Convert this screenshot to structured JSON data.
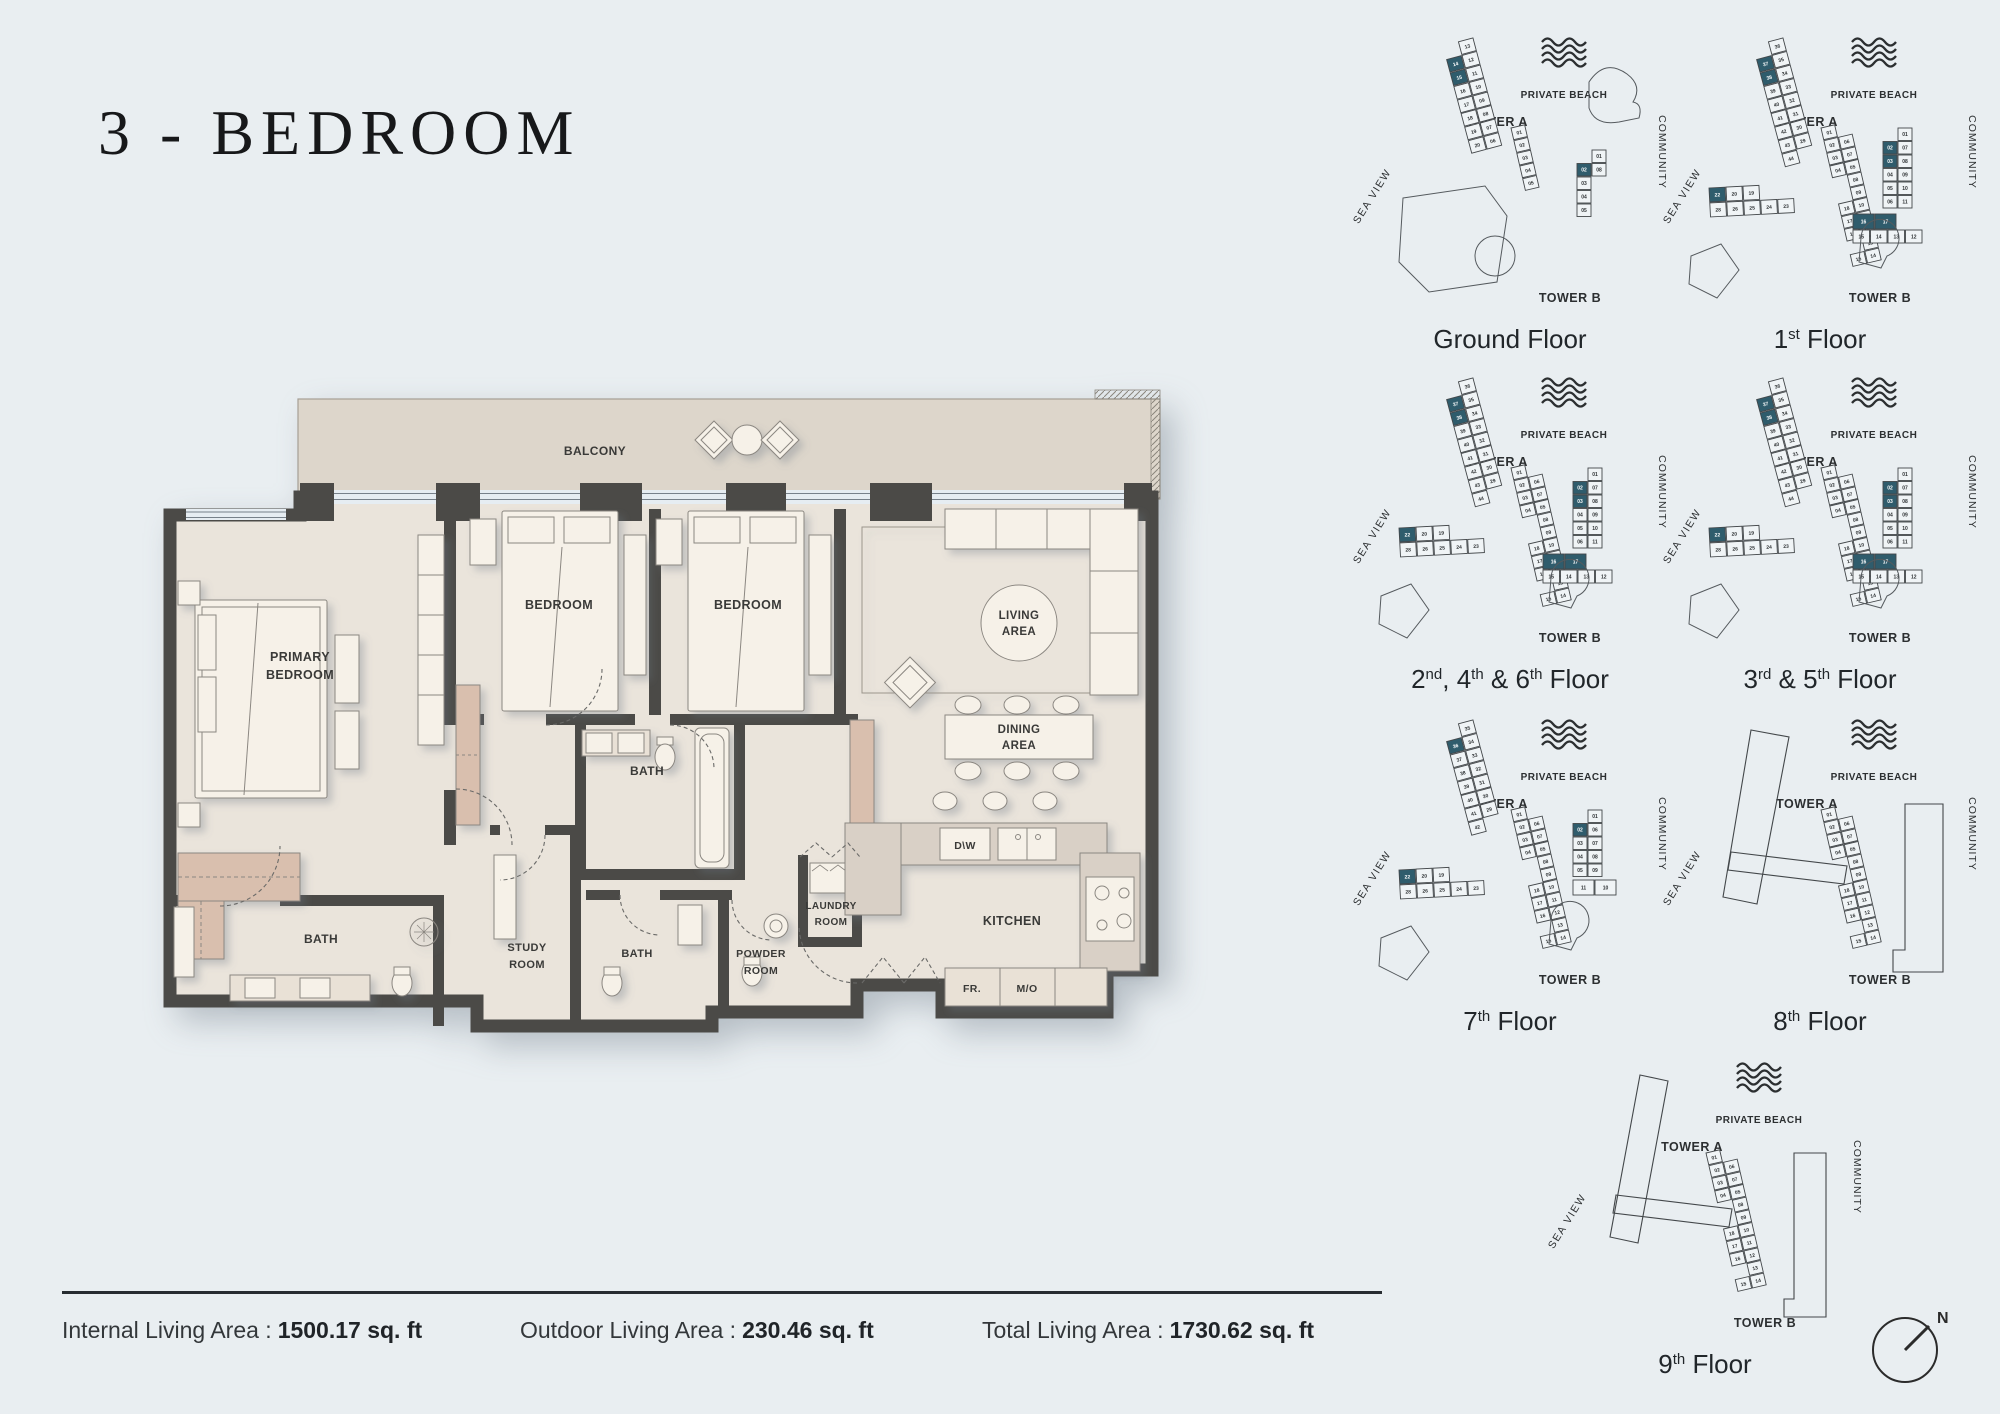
{
  "page": {
    "bg": "#e9eef1",
    "wall": "#4b4a47",
    "floor": "#eae4db",
    "balcony": "#ddd6cb",
    "counter": "#d9d0c6",
    "counter_light": "#e9e1d6",
    "pink": "#d9bfae",
    "furniture": "#f6f1e8",
    "line": "#8b8781",
    "teal": "#2f5c6c",
    "kp_line": "#43474a"
  },
  "title": "3 - BEDROOM",
  "floorplan": {
    "labels": {
      "balcony": "BALCONY",
      "primary_1": "PRIMARY",
      "primary_2": "BEDROOM",
      "bedroom": "BEDROOM",
      "living_1": "LIVING",
      "living_2": "AREA",
      "dining_1": "DINING",
      "dining_2": "AREA",
      "bath": "BATH",
      "study_1": "STUDY",
      "study_2": "ROOM",
      "powder_1": "POWDER",
      "powder_2": "ROOM",
      "laundry_1": "LAUNDRY",
      "laundry_2": "ROOM",
      "kitchen": "KITCHEN",
      "fr": "FR.",
      "mo": "M/O",
      "dw": "D\\W"
    }
  },
  "keyplan_labels": {
    "private_beach": "PRIVATE BEACH",
    "tower_a": "TOWER A",
    "tower_b": "TOWER B",
    "sea_view": "SEA VIEW",
    "community": "COMMUNITY"
  },
  "keyplans": [
    {
      "id": "ground",
      "caption": [
        {
          "t": "Ground Floor"
        }
      ],
      "towerA": {
        "arm1": [
          [
            "",
            "13"
          ],
          [
            "14*",
            "12"
          ],
          [
            "15*",
            "11"
          ],
          [
            "16",
            "10"
          ],
          [
            "17",
            "09"
          ],
          [
            "18",
            "08"
          ],
          [
            "19",
            "07"
          ],
          [
            "20",
            "06"
          ]
        ],
        "conn": null,
        "arm2": [
          [
            "01",
            ""
          ],
          [
            "02",
            ""
          ],
          [
            "03",
            ""
          ],
          [
            "04",
            ""
          ],
          [
            "05",
            ""
          ]
        ]
      },
      "towerB": {
        "rows": [
          [
            "",
            "01"
          ],
          [
            "02*",
            "08"
          ],
          [
            "03",
            ""
          ],
          [
            "04",
            ""
          ],
          [
            "05",
            ""
          ]
        ],
        "bottom": []
      }
    },
    {
      "id": "first",
      "caption": [
        {
          "t": "1"
        },
        {
          "t": "st",
          "sup": true
        },
        {
          "t": " Floor"
        }
      ],
      "towerA": {
        "arm1": [
          [
            "",
            "36"
          ],
          [
            "37*",
            "35"
          ],
          [
            "38*",
            "34"
          ],
          [
            "39",
            "33"
          ],
          [
            "40",
            "32"
          ],
          [
            "41",
            "31"
          ],
          [
            "42",
            "30"
          ],
          [
            "43",
            "29"
          ],
          [
            "44",
            ""
          ]
        ],
        "conn": [
          [
            "22*",
            "20",
            "19"
          ],
          [
            "28",
            "26",
            "25",
            "24",
            "23"
          ]
        ],
        "arm2": [
          [
            "01",
            ""
          ],
          [
            "02",
            "06"
          ],
          [
            "03",
            "07"
          ],
          [
            "04",
            "05"
          ],
          [
            "",
            "08"
          ],
          [
            "",
            "09"
          ],
          [
            "18",
            "10"
          ],
          [
            "17",
            "11"
          ],
          [
            "16",
            "12"
          ],
          [
            "",
            "13"
          ],
          [
            "15",
            "14"
          ]
        ]
      },
      "towerB": {
        "rows": [
          [
            "",
            "01"
          ],
          [
            "02*",
            "07"
          ],
          [
            "03*",
            "08"
          ],
          [
            "04",
            "09"
          ],
          [
            "05",
            "10"
          ],
          [
            "06",
            "11"
          ]
        ],
        "bottom": [
          [
            "16*",
            "17*"
          ],
          [
            "15",
            "14",
            "13",
            "12"
          ]
        ]
      }
    },
    {
      "id": "f246",
      "caption": [
        {
          "t": "2"
        },
        {
          "t": "nd",
          "sup": true
        },
        {
          "t": ", 4"
        },
        {
          "t": "th",
          "sup": true
        },
        {
          "t": " & 6"
        },
        {
          "t": "th",
          "sup": true
        },
        {
          "t": " Floor"
        }
      ],
      "towerA": {
        "arm1": [
          [
            "",
            "36"
          ],
          [
            "37*",
            "35"
          ],
          [
            "38*",
            "34"
          ],
          [
            "39",
            "33"
          ],
          [
            "40",
            "32"
          ],
          [
            "41",
            "31"
          ],
          [
            "42",
            "30"
          ],
          [
            "43",
            "29"
          ],
          [
            "44",
            ""
          ]
        ],
        "conn": [
          [
            "22*",
            "20",
            "19"
          ],
          [
            "28",
            "26",
            "25",
            "24",
            "23"
          ]
        ],
        "arm2": [
          [
            "01",
            ""
          ],
          [
            "02",
            "06"
          ],
          [
            "03",
            "07"
          ],
          [
            "04",
            "05"
          ],
          [
            "",
            "08"
          ],
          [
            "",
            "09"
          ],
          [
            "18",
            "10"
          ],
          [
            "17",
            "11"
          ],
          [
            "16",
            "12"
          ],
          [
            "",
            "13"
          ],
          [
            "15",
            "14"
          ]
        ]
      },
      "towerB": {
        "rows": [
          [
            "",
            "01"
          ],
          [
            "02*",
            "07"
          ],
          [
            "03*",
            "08"
          ],
          [
            "04",
            "09"
          ],
          [
            "05",
            "10"
          ],
          [
            "06",
            "11"
          ]
        ],
        "bottom": [
          [
            "16*",
            "17*"
          ],
          [
            "15",
            "14",
            "13",
            "12"
          ]
        ]
      }
    },
    {
      "id": "f35",
      "caption": [
        {
          "t": "3"
        },
        {
          "t": "rd",
          "sup": true
        },
        {
          "t": " & 5"
        },
        {
          "t": "th",
          "sup": true
        },
        {
          "t": " Floor"
        }
      ],
      "towerA": {
        "arm1": [
          [
            "",
            "36"
          ],
          [
            "37*",
            "35"
          ],
          [
            "38*",
            "34"
          ],
          [
            "39",
            "33"
          ],
          [
            "40",
            "32"
          ],
          [
            "41",
            "31"
          ],
          [
            "42",
            "30"
          ],
          [
            "43",
            "29"
          ],
          [
            "44",
            ""
          ]
        ],
        "conn": [
          [
            "22*",
            "20",
            "19"
          ],
          [
            "28",
            "26",
            "25",
            "24",
            "23"
          ]
        ],
        "arm2": [
          [
            "01",
            ""
          ],
          [
            "02",
            "06"
          ],
          [
            "03",
            "07"
          ],
          [
            "04",
            "05"
          ],
          [
            "",
            "08"
          ],
          [
            "",
            "09"
          ],
          [
            "18",
            "10"
          ],
          [
            "17",
            "11"
          ],
          [
            "16",
            "12"
          ],
          [
            "",
            "13"
          ],
          [
            "15",
            "14"
          ]
        ]
      },
      "towerB": {
        "rows": [
          [
            "",
            "01"
          ],
          [
            "02*",
            "07"
          ],
          [
            "03*",
            "08"
          ],
          [
            "04",
            "09"
          ],
          [
            "05",
            "10"
          ],
          [
            "06",
            "11"
          ]
        ],
        "bottom": [
          [
            "16*",
            "17*"
          ],
          [
            "15",
            "14",
            "13",
            "12"
          ]
        ]
      }
    },
    {
      "id": "f7",
      "caption": [
        {
          "t": "7"
        },
        {
          "t": "th",
          "sup": true
        },
        {
          "t": " Floor"
        }
      ],
      "towerA": {
        "arm1": [
          [
            "",
            "35"
          ],
          [
            "36*",
            "34"
          ],
          [
            "37",
            "33"
          ],
          [
            "38",
            "32"
          ],
          [
            "39",
            "31"
          ],
          [
            "40",
            "30"
          ],
          [
            "41",
            "29"
          ],
          [
            "42",
            ""
          ]
        ],
        "conn": [
          [
            "22*",
            "20",
            "19"
          ],
          [
            "28",
            "26",
            "25",
            "24",
            "23"
          ]
        ],
        "arm2": [
          [
            "01",
            ""
          ],
          [
            "02",
            "06"
          ],
          [
            "03",
            "07"
          ],
          [
            "04",
            "05"
          ],
          [
            "",
            "08"
          ],
          [
            "",
            "09"
          ],
          [
            "18",
            "10"
          ],
          [
            "17",
            "11"
          ],
          [
            "16",
            "12"
          ],
          [
            "",
            "13"
          ],
          [
            "15",
            "14"
          ]
        ]
      },
      "towerB": {
        "rows": [
          [
            "",
            "01"
          ],
          [
            "02*",
            "06"
          ],
          [
            "03",
            "07"
          ],
          [
            "04",
            "08"
          ],
          [
            "05",
            "09"
          ]
        ],
        "bottom": [
          [
            "11",
            "10"
          ]
        ]
      }
    },
    {
      "id": "f8",
      "caption": [
        {
          "t": "8"
        },
        {
          "t": "th",
          "sup": true
        },
        {
          "t": " Floor"
        }
      ],
      "towerA": {
        "arm1": [],
        "conn": null,
        "arm2": [
          [
            "01",
            ""
          ],
          [
            "02",
            "06"
          ],
          [
            "03",
            "07"
          ],
          [
            "04",
            "05"
          ],
          [
            "",
            "08"
          ],
          [
            "",
            "09"
          ],
          [
            "18",
            "10"
          ],
          [
            "17",
            "11"
          ],
          [
            "16",
            "12"
          ],
          [
            "",
            "13"
          ],
          [
            "15",
            "14"
          ]
        ]
      },
      "towerB": {
        "rows": [],
        "bottom": []
      }
    },
    {
      "id": "f9",
      "caption": [
        {
          "t": "9"
        },
        {
          "t": "th",
          "sup": true
        },
        {
          "t": " Floor"
        }
      ],
      "towerA": {
        "arm1": [],
        "conn": null,
        "arm2": [
          [
            "01",
            ""
          ],
          [
            "02",
            "06"
          ],
          [
            "03",
            "07"
          ],
          [
            "04",
            "05"
          ],
          [
            "",
            "08"
          ],
          [
            "",
            "09"
          ],
          [
            "18",
            "10"
          ],
          [
            "17",
            "11"
          ],
          [
            "16",
            "12"
          ],
          [
            "",
            "13"
          ],
          [
            "15",
            "14"
          ]
        ]
      },
      "towerB": {
        "rows": [],
        "bottom": []
      }
    }
  ],
  "summary": {
    "items": [
      {
        "label": "Internal Living Area :",
        "value": "1500.17 sq. ft"
      },
      {
        "label": "Outdoor Living Area :",
        "value": "230.46 sq. ft"
      },
      {
        "label": "Total Living Area :",
        "value": "1730.62 sq. ft"
      }
    ]
  },
  "compass": {
    "label": "N"
  }
}
